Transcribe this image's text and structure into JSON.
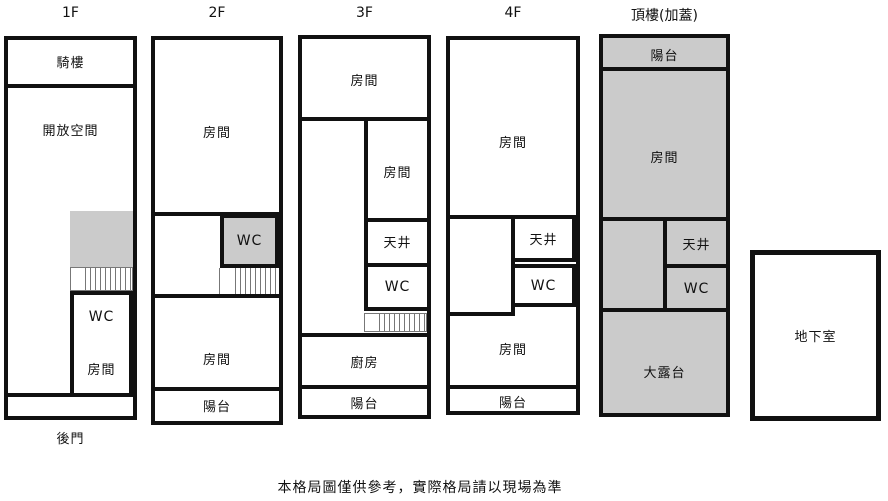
{
  "caption": "本格局圖僅供參考，實際格局請以現場為準",
  "colors": {
    "wall": "#111111",
    "room_fill": "#ffffff",
    "shaded_fill": "#cbcbcb"
  },
  "floors": {
    "f1": {
      "title": "1F",
      "rooms": {
        "arcade": "騎樓",
        "open_space": "開放空間",
        "wc": "WC",
        "room": "房間",
        "back_door": "後門"
      }
    },
    "f2": {
      "title": "2F",
      "rooms": {
        "room_top": "房間",
        "wc": "WC",
        "room_bottom": "房間",
        "balcony": "陽台"
      }
    },
    "f3": {
      "title": "3F",
      "rooms": {
        "room_top": "房間",
        "room_mid": "房間",
        "light_well": "天井",
        "wc": "WC",
        "kitchen": "廚房",
        "balcony": "陽台"
      }
    },
    "f4": {
      "title": "4F",
      "rooms": {
        "room_top": "房間",
        "light_well": "天井",
        "wc": "WC",
        "room_bottom": "房間",
        "balcony": "陽台"
      }
    },
    "roof": {
      "title": "頂樓(加蓋)",
      "rooms": {
        "balcony": "陽台",
        "room": "房間",
        "light_well": "天井",
        "wc": "WC",
        "terrace": "大露台"
      }
    },
    "basement": {
      "title": "地下室"
    }
  }
}
